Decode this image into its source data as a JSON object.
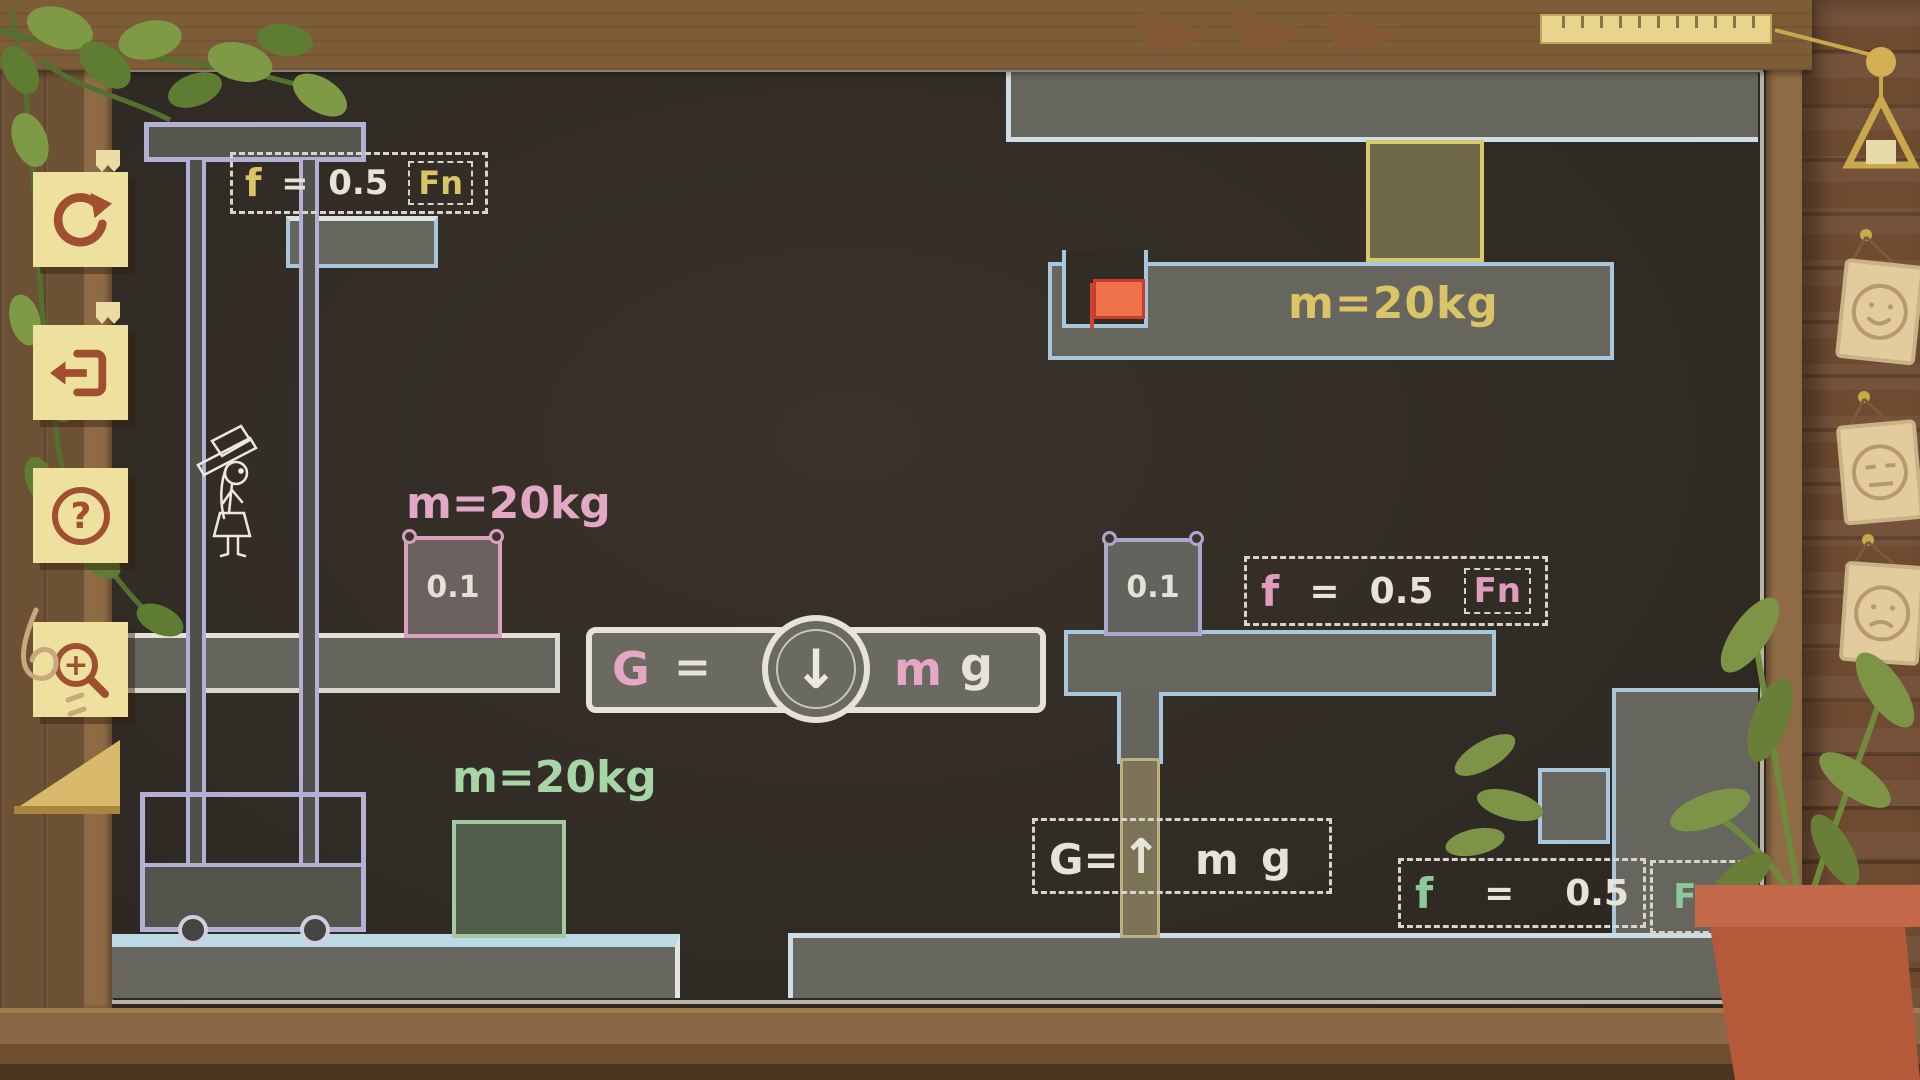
{
  "sidebar": {
    "buttons": [
      {
        "id": "restart",
        "label": "restart level"
      },
      {
        "id": "exit",
        "label": "exit level"
      },
      {
        "id": "help",
        "label": "help",
        "glyph": "?"
      },
      {
        "id": "zoom_in",
        "label": "zoom in",
        "glyph": "+"
      }
    ]
  },
  "level": {
    "masses": {
      "yellow_block": "m=20kg",
      "pink_block": "m=20kg",
      "green_block": "m=20kg"
    },
    "friction_values": {
      "pink_block": "0.1",
      "purple_block": "0.1"
    },
    "formulas": {
      "top_left": {
        "lhs": "f",
        "eq": "=",
        "value": "0.5",
        "rhs": "Fn"
      },
      "mid_right": {
        "lhs": "f",
        "eq": "=",
        "value": "0.5",
        "rhs": "Fn"
      },
      "bottom_right": {
        "lhs": "f",
        "eq": "=",
        "value": "0.5",
        "rhs": "Fn"
      },
      "gravity_main": {
        "g": "G",
        "eq": "=",
        "arrow": "↓",
        "m": "m",
        "g2": "g"
      },
      "gravity_up": {
        "lhs": "G=",
        "arrow": "↑",
        "m": "m",
        "g": "g"
      }
    }
  },
  "colors": {
    "chalk_white": "#e8e5d9",
    "chalk_yellow": "#d9c565",
    "chalk_pink": "#e2a6c4",
    "chalk_green": "#9ed2a4",
    "chalk_blue": "#a9c7dc",
    "chalk_lavender": "#b3b0d6",
    "flag_orange": "#ef7149",
    "board_dark": "#322c27",
    "button_cream": "#eee1a0",
    "button_icon_brown": "#a04f30"
  }
}
